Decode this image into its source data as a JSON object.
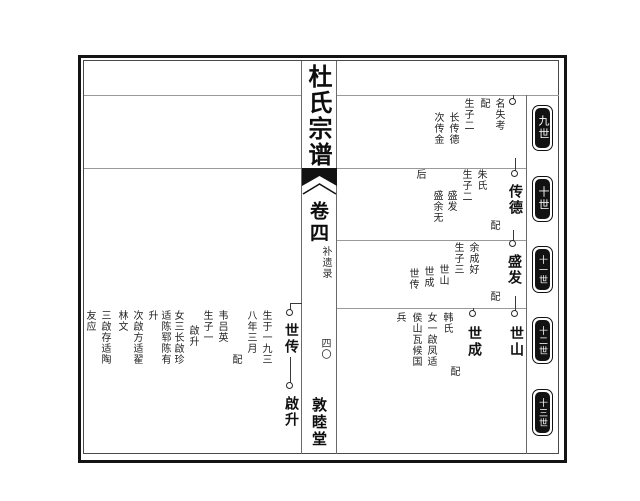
{
  "spine": {
    "title": "杜氏宗谱",
    "volume": "卷四",
    "section": "补遗录",
    "page_number": "四〇",
    "hall": "敦睦堂"
  },
  "generations": [
    "九世",
    "十世",
    "十一世",
    "十二世",
    "十三世"
  ],
  "rows": {
    "r9": {
      "note_name": "名失考",
      "spouse_label": "配",
      "children_heading": "生子二",
      "child1": "长传德",
      "child2": "次传金"
    },
    "r10": {
      "name": "传德",
      "spouse_label": "配",
      "spouse": "朱氏",
      "children_heading": "生子二",
      "child1": "盛发",
      "child2": "盛余无",
      "child2_cont": "后"
    },
    "r11": {
      "name": "盛发",
      "spouse_label": "配",
      "spouse": "余成好",
      "children_heading": "生子三",
      "child1": "世山",
      "child2": "世成",
      "child3": "世传"
    },
    "r12": {
      "shishan": {
        "name": "世山"
      },
      "shicheng": {
        "name": "世成",
        "spouse_label": "配",
        "spouse": "韩氏",
        "daughter_line1": "女一啟凤适",
        "daughter_line2": "侯山瓦候国",
        "daughter_line3": "兵"
      }
    },
    "left": {
      "shichuan": {
        "name": "世传",
        "birth1": "生于一九三",
        "birth2": "八年三月",
        "spouse_label": "配",
        "spouse": "韦吕英",
        "son_heading": "生子一",
        "son": "啟升",
        "daughters1": "女三长啟珍",
        "daughters2": "适陈郓陈有",
        "daughters3": "升",
        "daughters4": "次啟方适翟",
        "daughters5": "林文",
        "daughters6": "三啟存适陶",
        "daughters7": "友应"
      },
      "qisheng": {
        "name": "啟升"
      }
    }
  },
  "colors": {
    "ink": "#1a1a1a",
    "grid_line": "#9a9a9a",
    "badge_bg": "#121212"
  }
}
